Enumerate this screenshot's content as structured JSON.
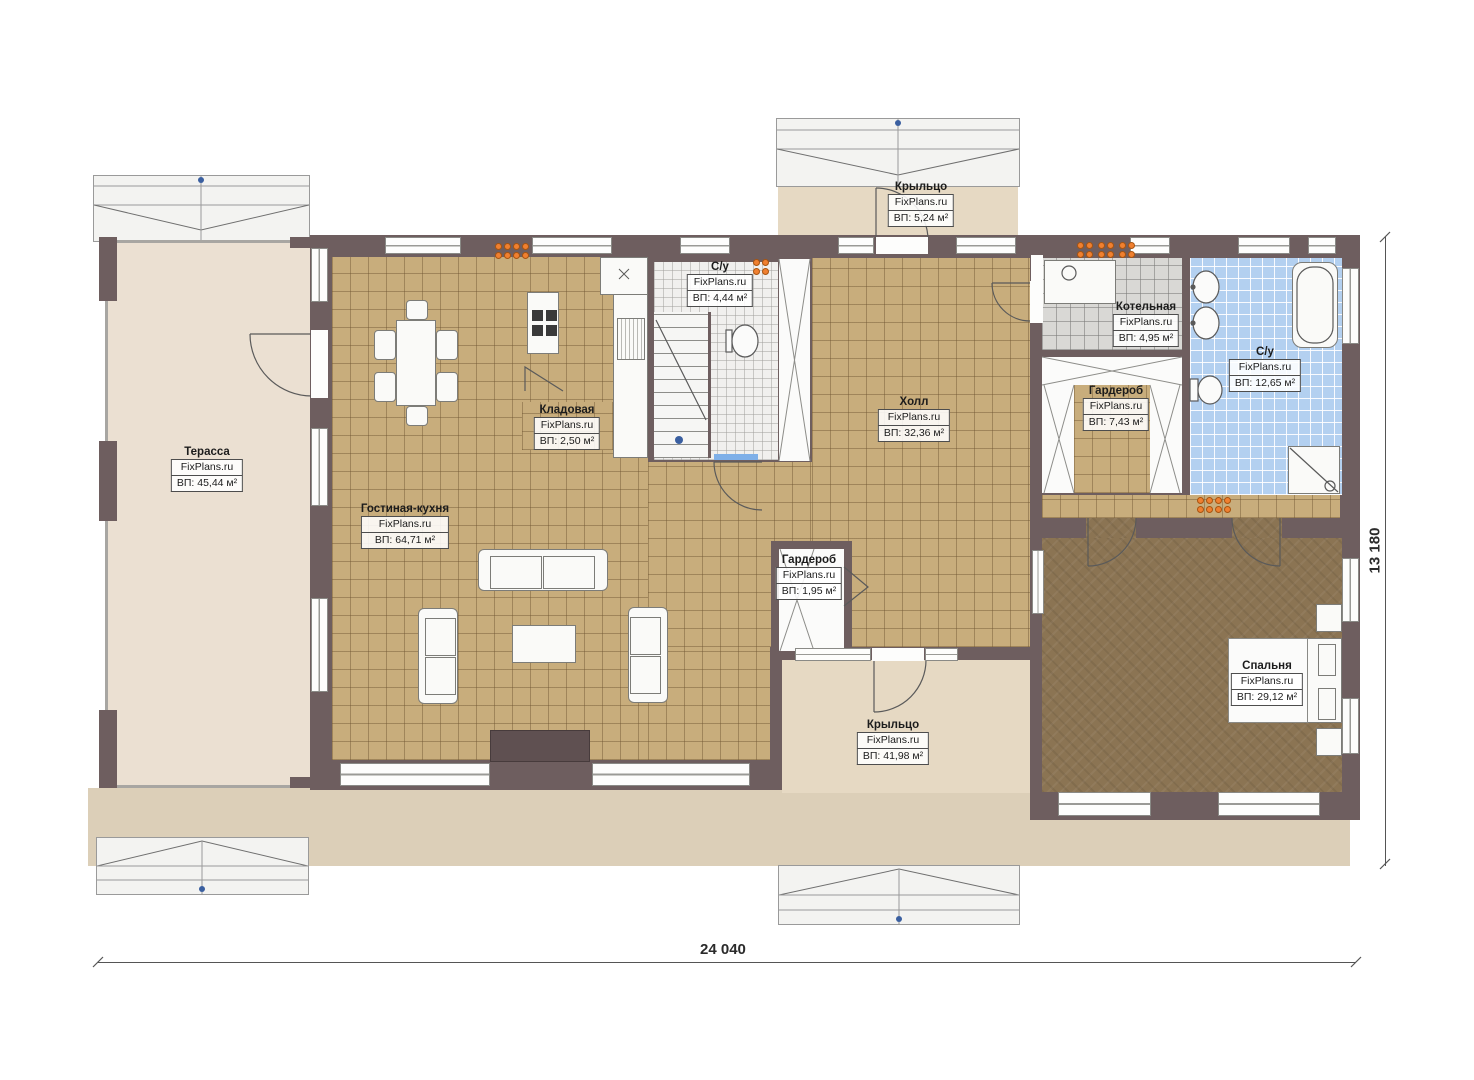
{
  "plan": {
    "brand": "FixPlans.ru",
    "rooms": [
      {
        "name": "Терасса",
        "area": "ВП: 45,44 м²"
      },
      {
        "name": "Крыльцо",
        "area": "ВП: 5,24 м²"
      },
      {
        "name": "С/у",
        "area": "ВП: 4,44 м²"
      },
      {
        "name": "Гостиная-кухня",
        "area": "ВП: 64,71 м²"
      },
      {
        "name": "Кладовая",
        "area": "ВП: 2,50 м²"
      },
      {
        "name": "Холл",
        "area": "ВП: 32,36 м²"
      },
      {
        "name": "Котельная",
        "area": "ВП: 4,95 м²"
      },
      {
        "name": "Гардероб",
        "area": "ВП: 7,43 м²"
      },
      {
        "name": "С/у",
        "area": "ВП: 12,65 м²"
      },
      {
        "name": "Гардероб",
        "area": "ВП: 1,95 м²"
      },
      {
        "name": "Крыльцо",
        "area": "ВП: 41,98 м²"
      },
      {
        "name": "Спальня",
        "area": "ВП: 29,12 м²"
      }
    ],
    "dimensions": {
      "width": "24 040",
      "height": "13 180"
    },
    "colors": {
      "wall": "#6e5e5f",
      "tile_floor": "#c8ad7c",
      "bedroom_floor": "#8b7453",
      "bath_floor": "#b3d0f0",
      "terrace_floor": "#ebe0d2",
      "marker_orange": "#f08030"
    }
  }
}
